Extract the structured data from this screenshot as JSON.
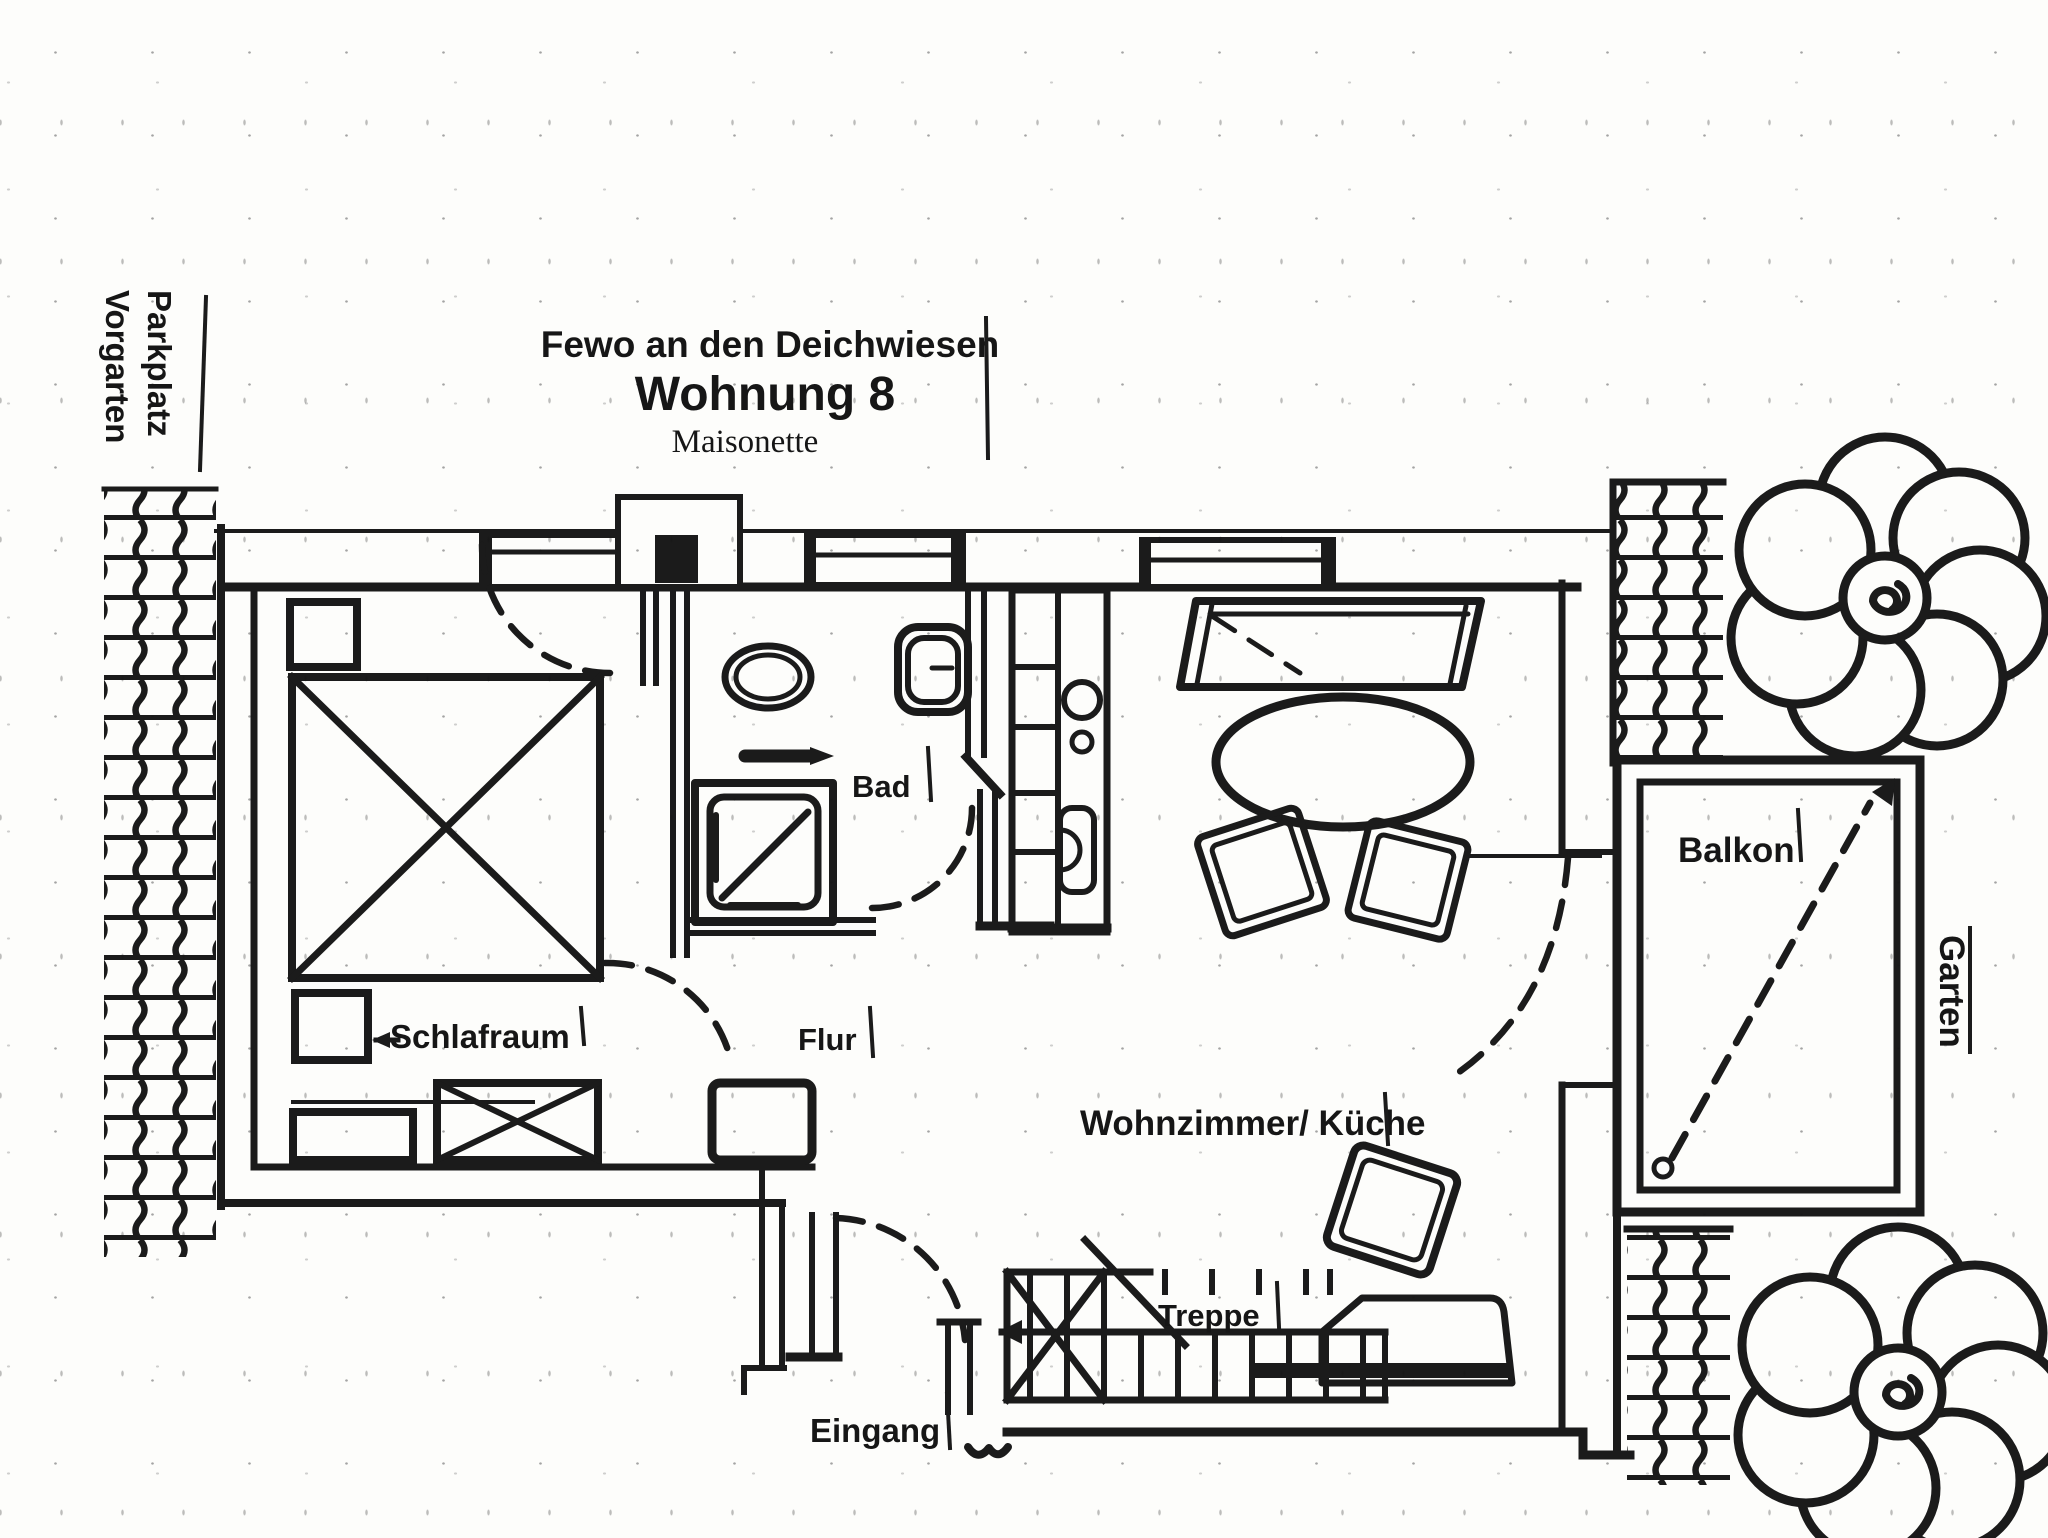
{
  "title": {
    "line1": "Fewo an den Deichwiesen",
    "line2": "Wohnung 8",
    "line3": "Maisonette"
  },
  "labels": {
    "vorgarten": "Vorgarten",
    "parkplatz": "Parkplatz",
    "schlafraum": "Schlafraum",
    "bad": "Bad",
    "flur": "Flur",
    "wohnzimmer_kueche": "Wohnzimmer/ Küche",
    "treppe": "Treppe",
    "eingang": "Eingang",
    "balkon": "Balkon",
    "garten": "Garten"
  },
  "colors": {
    "ink": "#1b1b1b",
    "paper": "#fdfdfb"
  }
}
